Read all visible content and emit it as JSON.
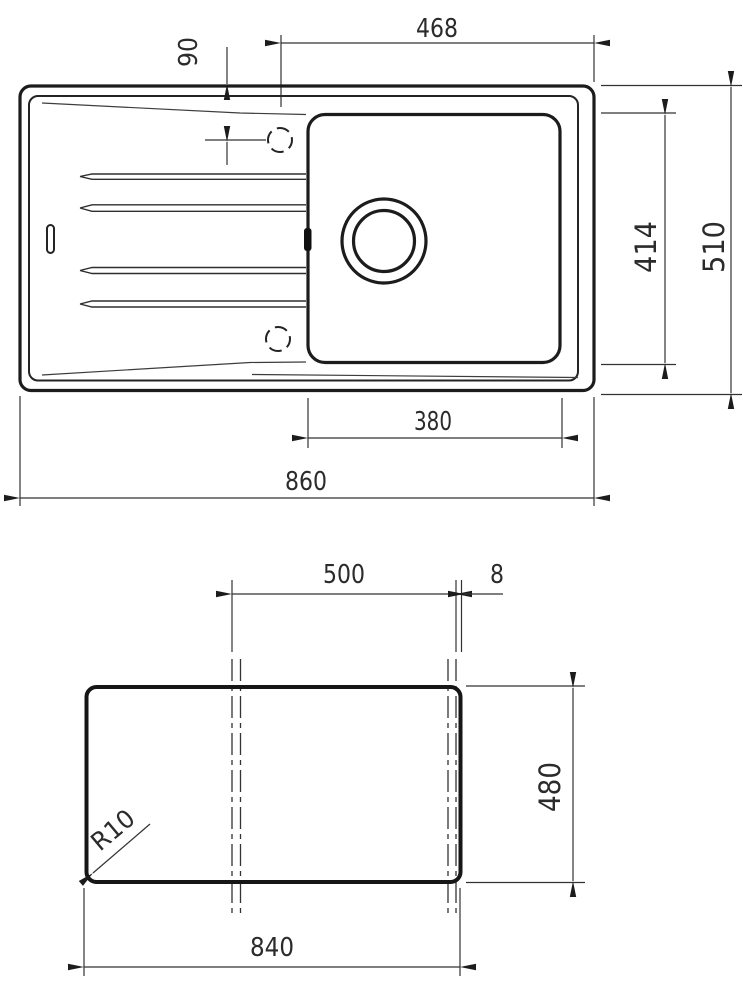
{
  "drawing_title": "sink-technical-drawing",
  "top_view": {
    "name": "sink top view with bowl and drainboard",
    "dims": {
      "right_zone_width": "468",
      "taphole_offset": "90",
      "bowl_length": "414",
      "overall_depth": "510",
      "bowl_width": "380",
      "overall_width": "860"
    }
  },
  "cutout_view": {
    "name": "worktop cutout template",
    "dims": {
      "centerline_span": "500",
      "edge_gap": "8",
      "cutout_height": "480",
      "cutout_width": "840",
      "corner_radius": "R10"
    }
  }
}
